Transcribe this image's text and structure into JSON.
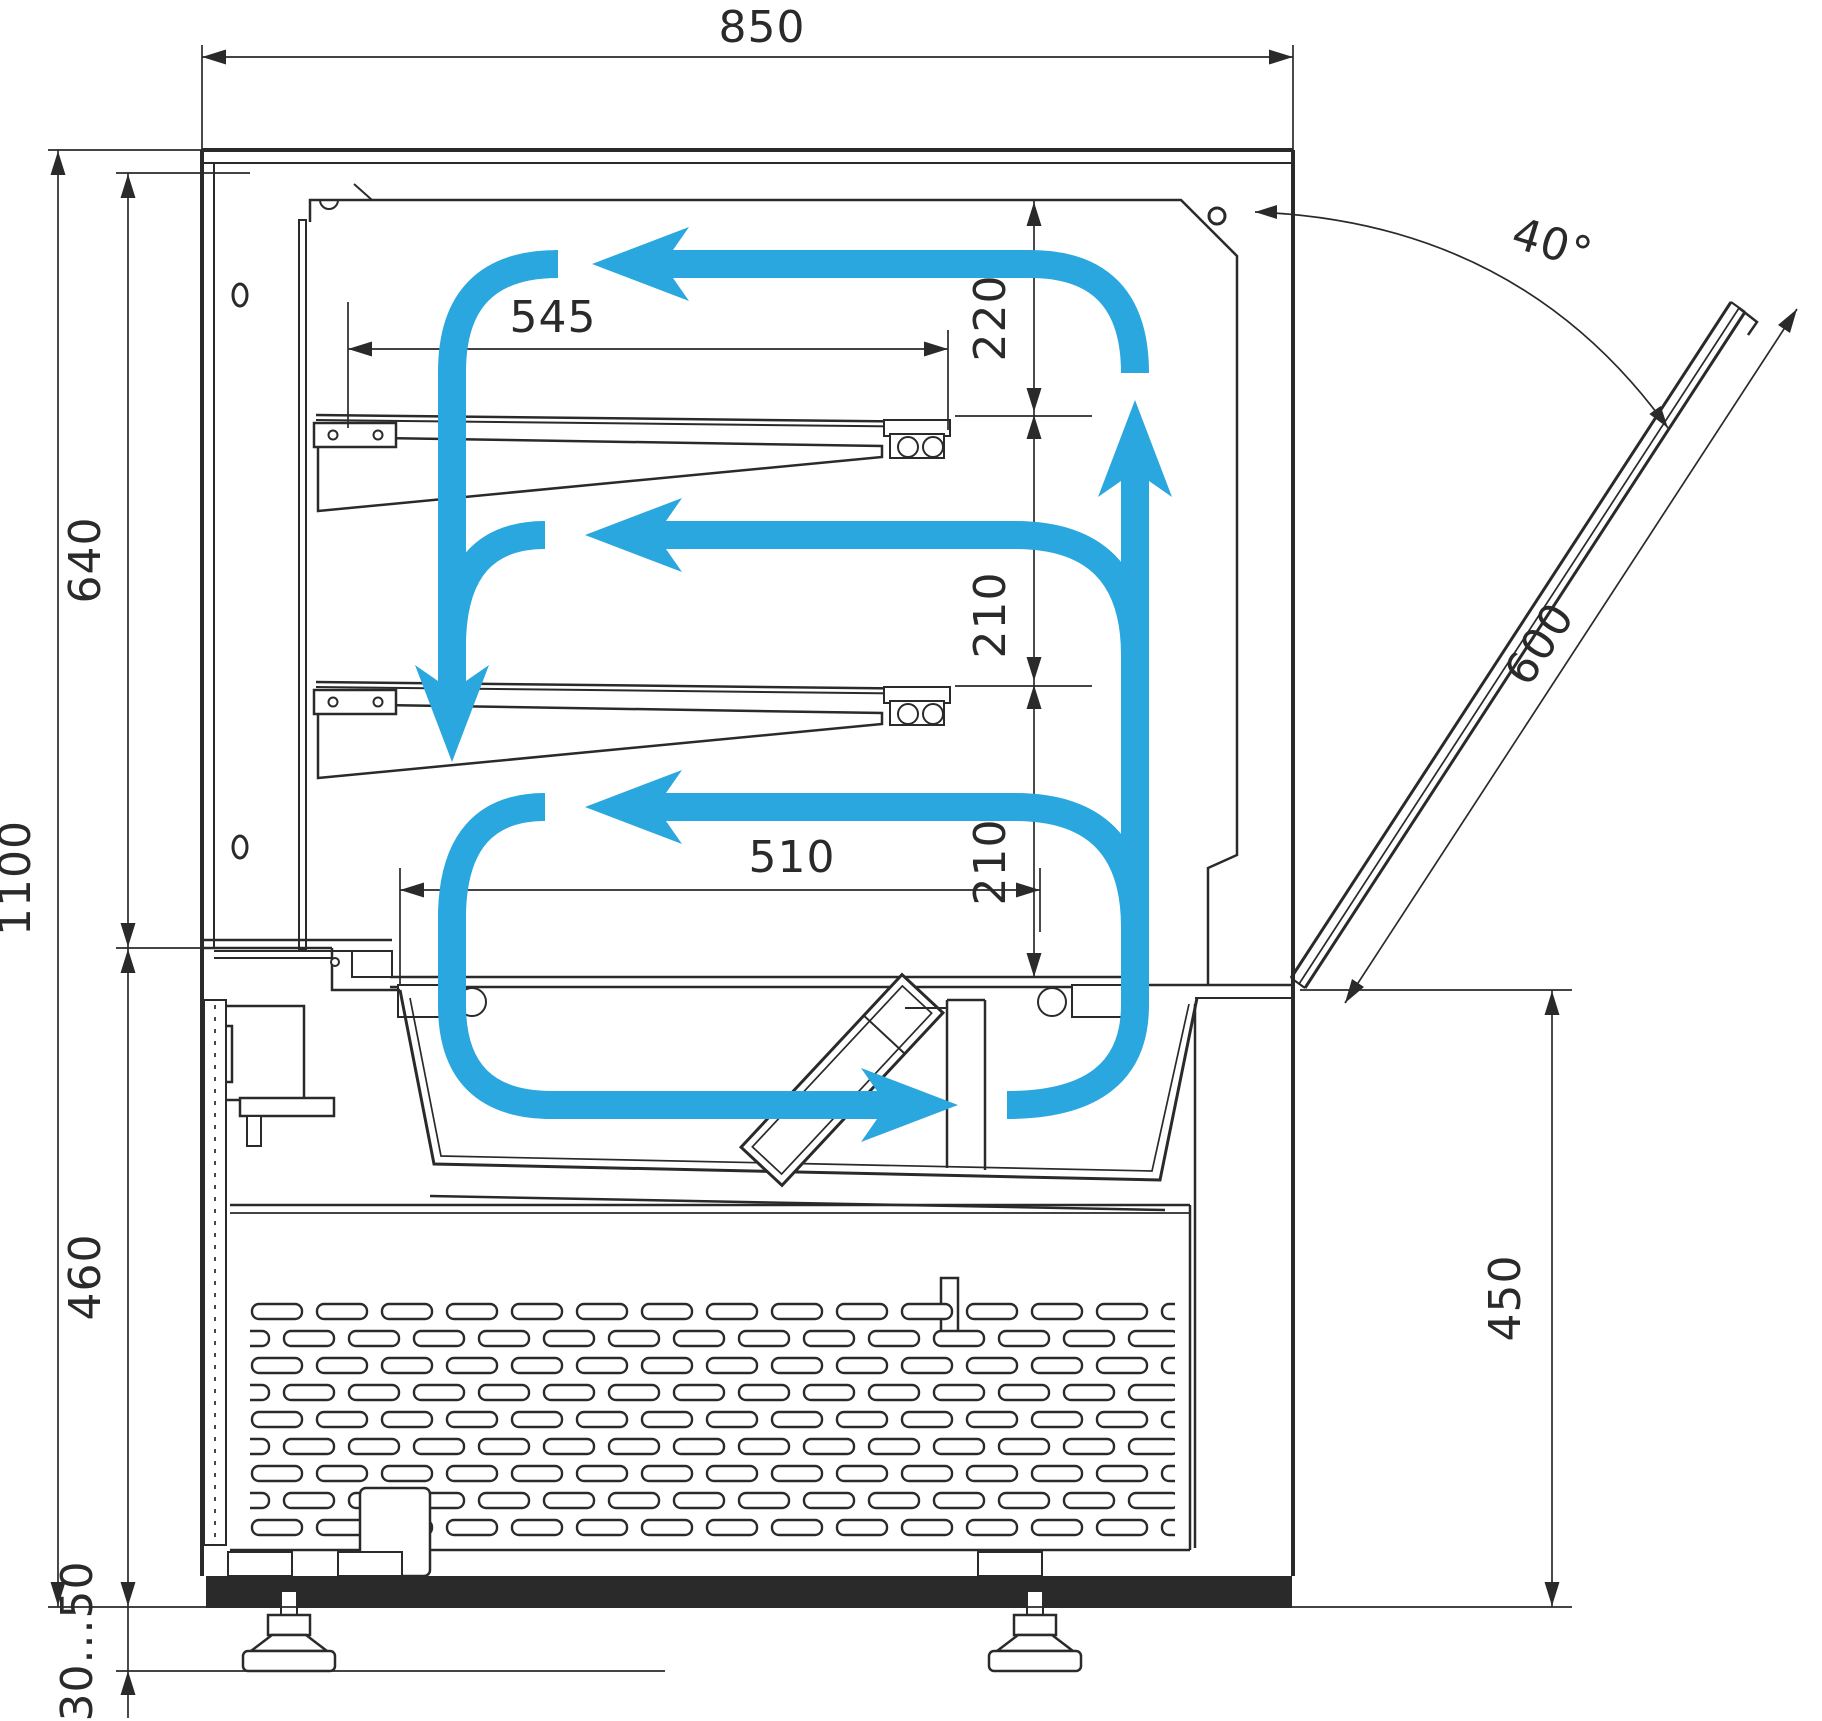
{
  "drawing": {
    "kind": "refrigerated-display-case-cross-section",
    "airflow_color": "#2BA7DF",
    "line_color": "#2A2A2A",
    "background": "#FFFFFF"
  },
  "dimensions": {
    "overall_width": "850",
    "shelf_depth": "545",
    "top_clearance": "220",
    "mid_clearance": "210",
    "low_clearance": "210",
    "well_width": "510",
    "upper_section_height": "640",
    "overall_height": "1100",
    "base_section_height": "460",
    "foot_adjust_range": "30...50",
    "rear_counter_height": "450",
    "door_glass_length": "600",
    "door_open_angle": "40°"
  },
  "icons": {
    "airflow_arrow": "blue-flow-arrow",
    "vent_hole": "oval-hole",
    "screw_hole": "round-hole"
  }
}
